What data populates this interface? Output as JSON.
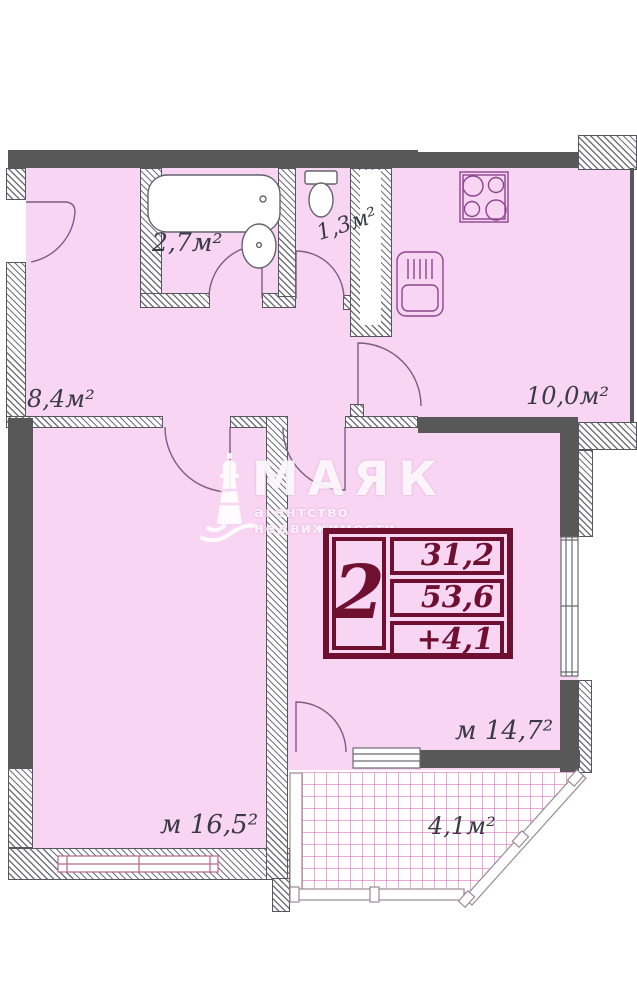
{
  "colors": {
    "room_fill": "#f8d5f2",
    "wall_dark": "#585858",
    "accent_maroon": "#701030",
    "balcony_grid_pink": "#db61c1",
    "label_text": "#3a3a45"
  },
  "watermark": {
    "brand": "МАЯК",
    "tagline": "агентство недвижимости"
  },
  "summary": {
    "rooms": "2",
    "living_area": "31,2",
    "total_area": "53,6",
    "extra_area": "+4,1"
  },
  "rooms": {
    "bathroom": {
      "label": "2,7м²"
    },
    "wc": {
      "label": "1,3м²"
    },
    "hallway": {
      "label": "8,4м²"
    },
    "kitchen": {
      "label": "10,0м²"
    },
    "bedroom": {
      "label": "м 16,5²"
    },
    "living_room": {
      "label": "м 14,7²"
    },
    "balcony": {
      "label": "4,1м²"
    }
  }
}
